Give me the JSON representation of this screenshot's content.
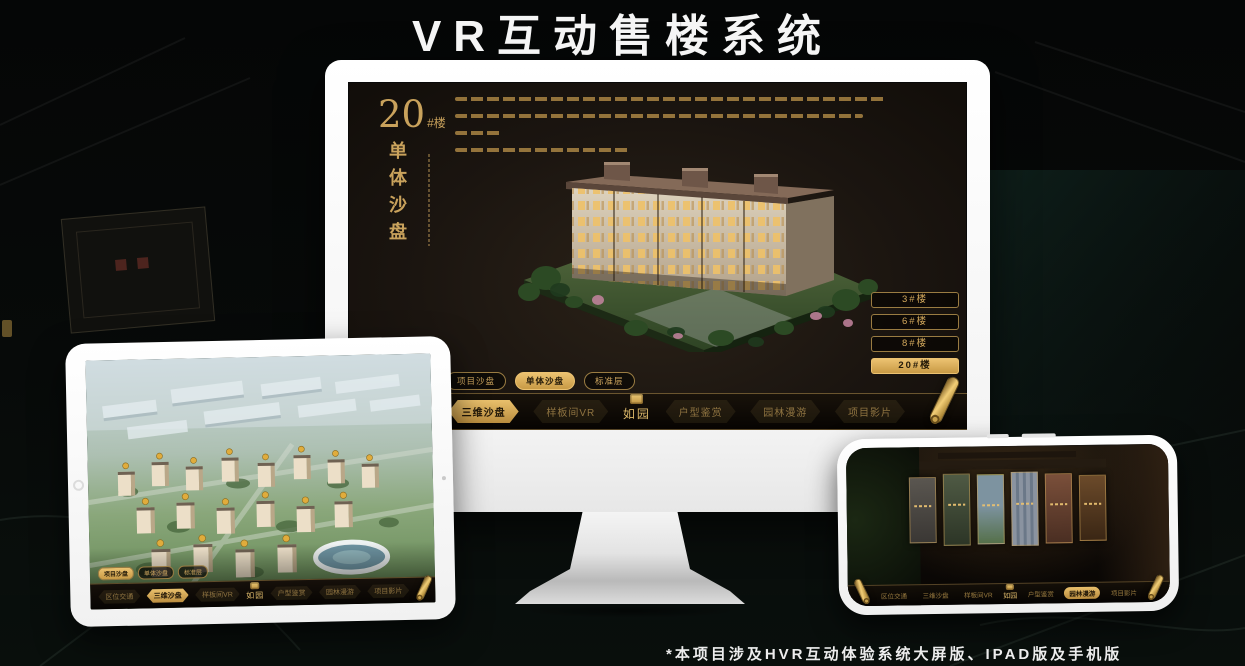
{
  "header": {
    "title": "VR互动售楼系统"
  },
  "footer": {
    "note": "*本项目涉及HVR互动体验系统大屏版、IPAD版及手机版"
  },
  "colors": {
    "gold": "#CDA55C",
    "gold_bright": "#E9C06C",
    "screen_bg": "#1B1510"
  },
  "desktop_app": {
    "headline": {
      "number": "20",
      "unit": "#楼",
      "subtitle_vertical": "单体沙盘"
    },
    "building_buttons": [
      {
        "label": "3#楼",
        "active": false
      },
      {
        "label": "6#楼",
        "active": false
      },
      {
        "label": "8#楼",
        "active": false
      },
      {
        "label": "20#楼",
        "active": true
      }
    ],
    "floor_tabs": [
      {
        "label": "项目沙盘",
        "active": false
      },
      {
        "label": "单体沙盘",
        "active": true
      },
      {
        "label": "标准层",
        "active": false
      }
    ],
    "nav": {
      "left_items": [
        {
          "label": "区位交通",
          "active": false
        },
        {
          "label": "三维沙盘",
          "active": true
        },
        {
          "label": "样板间VR",
          "active": false
        }
      ],
      "logo": "如园",
      "right_items": [
        {
          "label": "户型鉴赏",
          "active": false
        },
        {
          "label": "园林漫游",
          "active": false
        },
        {
          "label": "项目影片",
          "active": false
        }
      ]
    }
  },
  "tablet_app": {
    "floor_tabs": [
      {
        "label": "项目沙盘",
        "active": true
      },
      {
        "label": "单体沙盘",
        "active": false
      },
      {
        "label": "标准层",
        "active": false
      }
    ],
    "nav": {
      "left_items": [
        {
          "label": "区位交通",
          "active": false
        },
        {
          "label": "三维沙盘",
          "active": true
        },
        {
          "label": "样板间VR",
          "active": false
        }
      ],
      "logo": "如园",
      "right_items": [
        {
          "label": "户型鉴赏",
          "active": false
        },
        {
          "label": "园林漫游",
          "active": false
        },
        {
          "label": "项目影片",
          "active": false
        }
      ]
    }
  },
  "phone_app": {
    "nav": {
      "left_items": [
        {
          "label": "区位交通",
          "active": false
        },
        {
          "label": "三维沙盘",
          "active": false
        },
        {
          "label": "样板间VR",
          "active": false
        }
      ],
      "logo": "如园",
      "right_items": [
        {
          "label": "户型鉴赏",
          "active": false
        },
        {
          "label": "园林漫游",
          "active": true
        },
        {
          "label": "项目影片",
          "active": false
        }
      ]
    }
  }
}
